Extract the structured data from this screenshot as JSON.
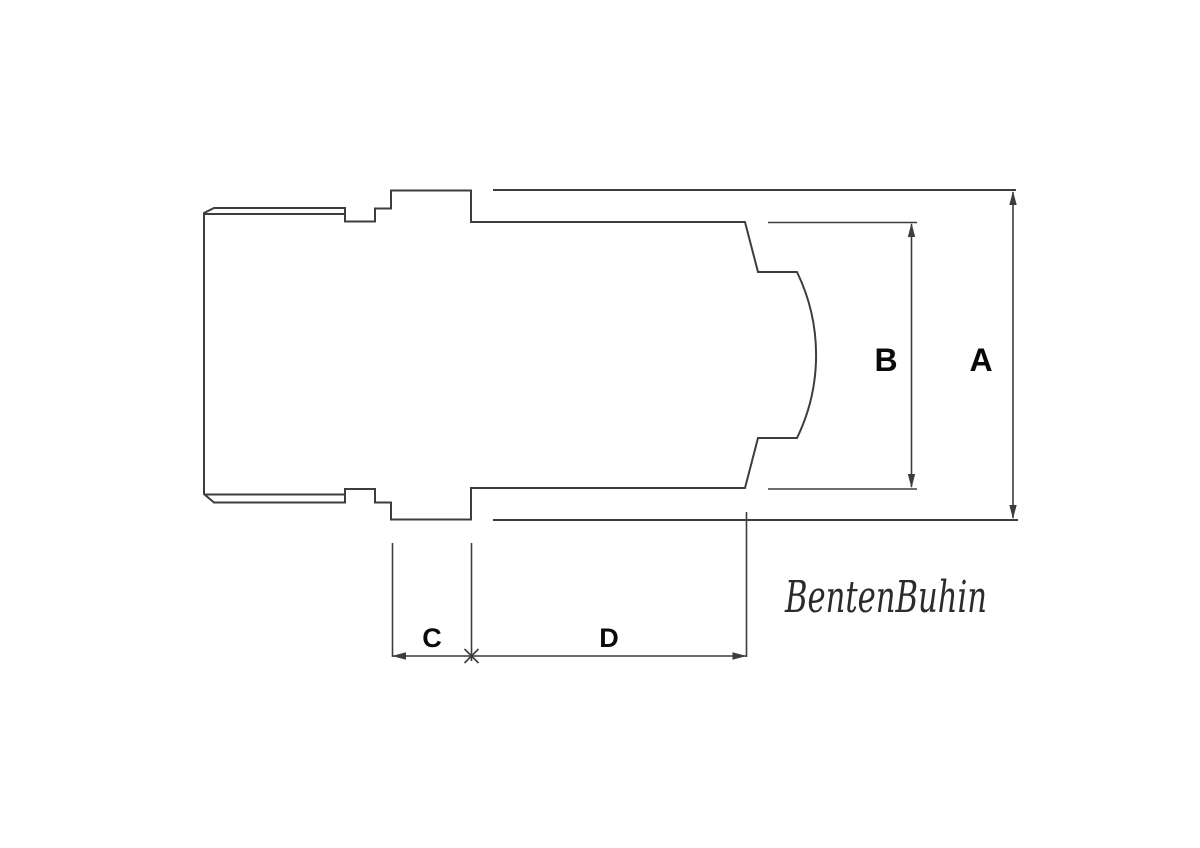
{
  "drawing": {
    "type": "technical-dimension-drawing",
    "part": "cylindrical machined part cross-section with stepped cap, flange and concave-ended barrel",
    "labels": {
      "a": "A",
      "b": "B",
      "c": "C",
      "d": "D"
    },
    "dimensions": [
      {
        "label": "A",
        "orientation": "vertical",
        "measures": "overall outer diameter of barrel"
      },
      {
        "label": "B",
        "orientation": "vertical",
        "measures": "inner bore opening diameter"
      },
      {
        "label": "C",
        "orientation": "horizontal",
        "measures": "flange width"
      },
      {
        "label": "D",
        "orientation": "horizontal",
        "measures": "bore depth"
      }
    ],
    "signature": "BentenBuhin"
  },
  "colors": {
    "background": "#ffffff",
    "line": "#3d3d3d",
    "label": "#0a0a0a",
    "signature": "#2b2b2b"
  }
}
